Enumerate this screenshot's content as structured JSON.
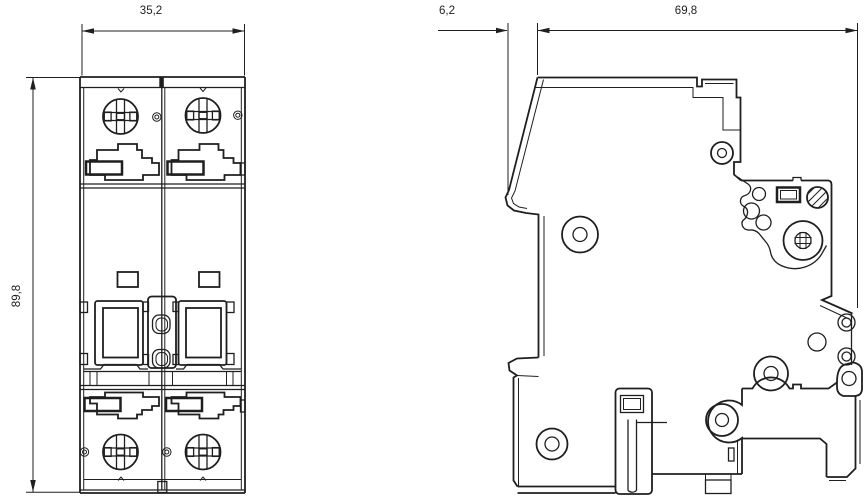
{
  "page": {
    "title": "circuit-breaker-dimension-drawing",
    "background": "#ffffff",
    "line_color": "#1f1f1f"
  },
  "views": {
    "front": {
      "name": "front-view",
      "dimensions": {
        "width": "35,2",
        "height": "89,8"
      }
    },
    "side": {
      "name": "side-view",
      "dimensions": {
        "front_depth": "6,2",
        "total_depth": "69,8"
      }
    }
  }
}
